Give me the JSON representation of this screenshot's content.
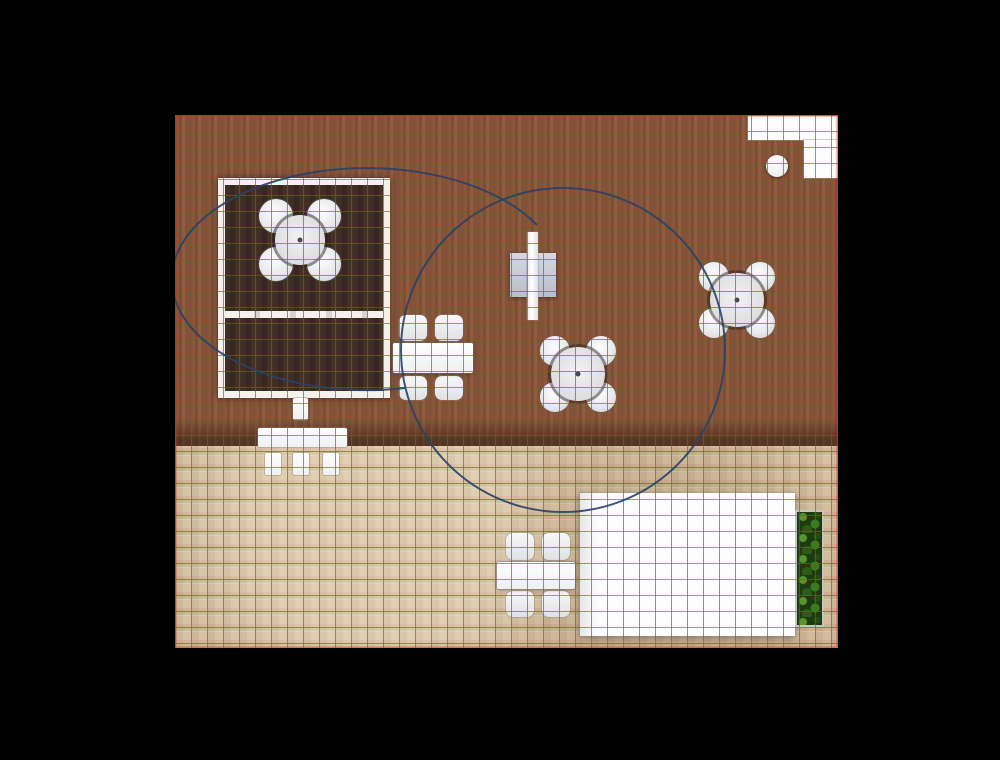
{
  "canvas": {
    "width": 1000,
    "height": 760,
    "background": "#000000"
  },
  "plan": {
    "x": 175,
    "y": 115,
    "width": 663,
    "height": 533,
    "grid": {
      "cell": 16,
      "color": "#dd2a12",
      "line_width": 1.6,
      "opacity": 0.85
    },
    "floors": [
      {
        "id": "wood",
        "name": "wood-plank-floor",
        "x": 0,
        "y": 0,
        "width": 663,
        "height": 331
      },
      {
        "id": "tile",
        "name": "tile-floor",
        "x": 0,
        "y": 331,
        "width": 663,
        "height": 202
      }
    ]
  },
  "arcs": {
    "color": "#2e4066",
    "line_width": 2,
    "opacity": 0.9,
    "items": [
      {
        "type": "circle",
        "cx": 388,
        "cy": 235,
        "r": 162
      },
      {
        "type": "ellipseArc",
        "rx": 195,
        "ry": 111,
        "start": [
          230,
          273
        ],
        "end": [
          362,
          110
        ],
        "largeArc": 1,
        "sweep": 1
      }
    ]
  },
  "objects": [
    {
      "type": "room",
      "name": "walled-room",
      "x": 43,
      "y": 63,
      "width": 172,
      "height": 220,
      "wall": 7,
      "divider_top": 126
    },
    {
      "type": "roundTable",
      "name": "round-table-room",
      "cx": 125,
      "cy": 125,
      "tableR": 25,
      "chairR": 17,
      "offset": 24
    },
    {
      "type": "tvUnit",
      "name": "tv-console",
      "parts": [
        [
          118,
          283,
          15,
          22
        ],
        [
          83,
          313,
          89,
          19
        ],
        [
          90,
          338,
          16,
          22
        ],
        [
          118,
          338,
          16,
          22
        ],
        [
          148,
          338,
          16,
          22
        ]
      ]
    },
    {
      "type": "rectTable",
      "name": "dining-table-wood",
      "table": [
        218,
        228,
        80,
        30
      ],
      "chairs": [
        [
          224,
          200,
          28,
          26
        ],
        [
          260,
          200,
          28,
          26
        ],
        [
          224,
          261,
          28,
          24
        ],
        [
          260,
          261,
          28,
          24
        ]
      ]
    },
    {
      "type": "piano",
      "name": "piano",
      "square": [
        335,
        138,
        46,
        44
      ],
      "bar": [
        352,
        117,
        11,
        88
      ]
    },
    {
      "type": "roundTable",
      "name": "round-table-center",
      "cx": 403,
      "cy": 259,
      "tableR": 27,
      "chairR": 15,
      "offset": 23
    },
    {
      "type": "roundTable",
      "name": "round-table-right",
      "cx": 562,
      "cy": 185,
      "tableR": 27,
      "chairR": 15,
      "offset": 23
    },
    {
      "type": "counter",
      "name": "corner-counter",
      "rects": [
        [
          573,
          0,
          90,
          25
        ],
        [
          629,
          25,
          34,
          38
        ]
      ],
      "stool": {
        "cx": 602,
        "cy": 51,
        "r": 11
      }
    },
    {
      "type": "bed",
      "name": "bed",
      "x": 405,
      "y": 378,
      "width": 215,
      "height": 143
    },
    {
      "type": "hedge",
      "name": "hedge-planter",
      "x": 622,
      "y": 397,
      "width": 25,
      "height": 113
    },
    {
      "type": "rectTable",
      "name": "patio-table",
      "table": [
        322,
        447,
        78,
        27
      ],
      "chairs": [
        [
          331,
          418,
          28,
          27
        ],
        [
          367,
          418,
          28,
          27
        ],
        [
          331,
          476,
          28,
          26
        ],
        [
          367,
          476,
          28,
          26
        ]
      ]
    }
  ],
  "colors": {
    "background": "#000000",
    "grid_red": "#dd2a12",
    "arc_navy": "#2e4066",
    "wall_white": "#f4f1ec",
    "wood1": "#82593f",
    "wood2": "#74503a",
    "wood3": "#8a6147",
    "wood4": "#7b553d",
    "room_floor1": "#402d24",
    "room_floor2": "#362720",
    "room_floor3": "#453227",
    "tile_beige": "#d6c2a3",
    "planter_gray": "#c5c5c0",
    "hedge_green": "#2c5c17",
    "furniture_white": "#fbfbfb"
  }
}
